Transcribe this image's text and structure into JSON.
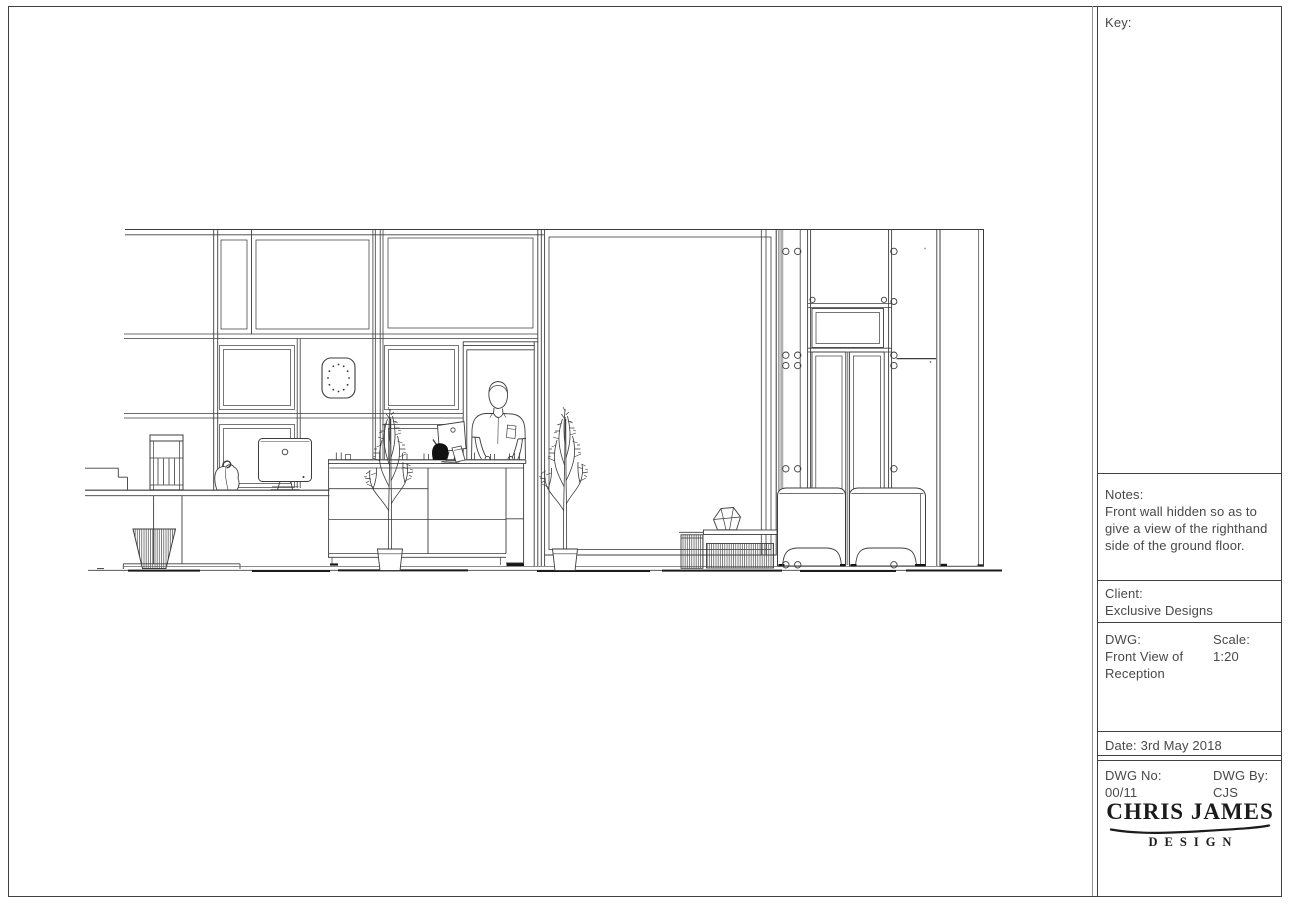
{
  "sheet": {
    "background": "#ffffff",
    "line_color": "#3d3d3d"
  },
  "title_block": {
    "key_label": "Key:",
    "notes_label": "Notes:",
    "notes_text": "Front wall hidden so as to give a view of the righthand side of the ground floor.",
    "client_label": "Client:",
    "client_value": "Exclusive Designs",
    "dwg_label": "DWG:",
    "dwg_value": "Front View of Reception",
    "scale_label": "Scale:",
    "scale_value": "1:20",
    "dwg_no_label": "DWG No:",
    "dwg_no_value": "00/11",
    "dwg_by_label": "DWG By:",
    "dwg_by_value": "CJS",
    "date_text": "Date: 3rd May 2018",
    "logo_primary": "CHRIS JAMES",
    "logo_secondary": "DESIGN"
  },
  "drawing": {
    "title": "Front elevation line drawing of ground floor reception",
    "elements": [
      "panelled wall",
      "wall clock",
      "coffee machine",
      "side desk with iMac",
      "carrier bag",
      "waste basket",
      "reception counter",
      "receptionist figure",
      "iMac on counter",
      "two potted trees",
      "full-height glazed panel",
      "panelled double door with transom",
      "fixing screws",
      "two armchairs",
      "ribbed coffee table with vase",
      "ribbed side table",
      "structural column"
    ]
  }
}
